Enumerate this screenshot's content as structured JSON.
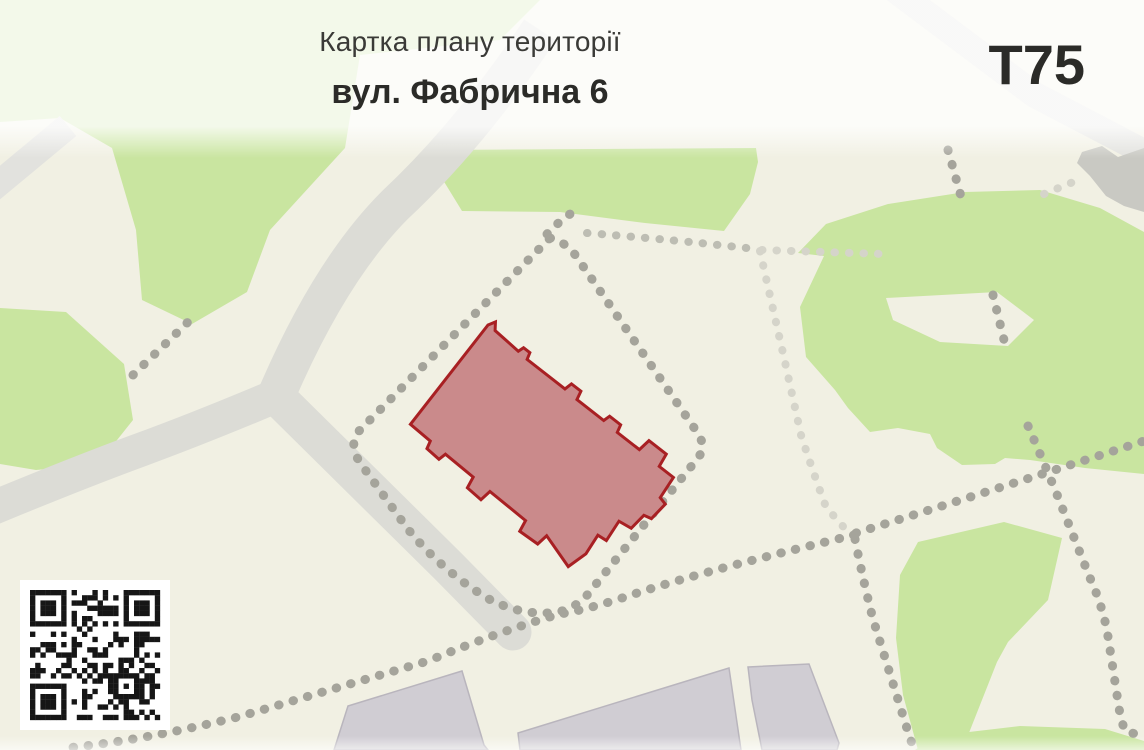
{
  "header": {
    "title": "Картка плану території",
    "subtitle": "вул. Фабрична 6",
    "code": "Т75"
  },
  "qr": {
    "modules": 25,
    "seed": 7
  },
  "colors": {
    "map_bg": "#f1f0e3",
    "green": "#c9e5a0",
    "road": "#dcdcd6",
    "road_light": "#e2e2de",
    "dots": "#a5a49b",
    "dots_mid": "#bdbdb3",
    "dots_light": "#d5d4ca",
    "bldg_fill": "#d0cdd3",
    "bldg_stroke": "#b9b5bd",
    "blob": "#c9c9c3",
    "hl_fill": "#ca8a8b",
    "hl_stroke": "#a82023",
    "qr": "#161616",
    "title": "#3a3a37",
    "strong": "#2b2b28"
  }
}
